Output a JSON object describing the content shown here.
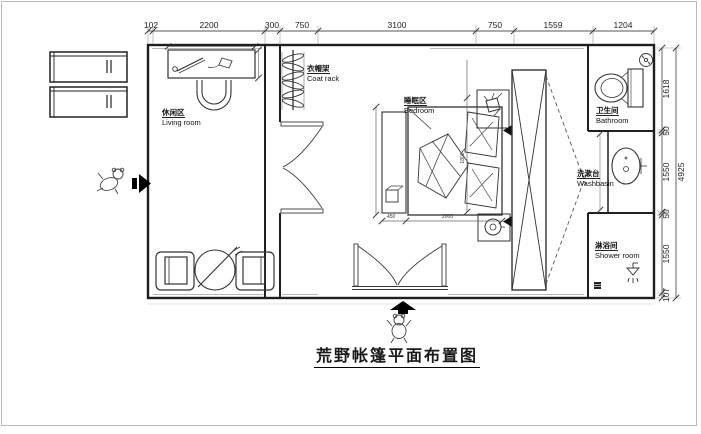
{
  "drawing": {
    "title": "荒野帐篷平面布置图"
  },
  "rooms": {
    "living": {
      "zh": "休闲区",
      "en": "Living room"
    },
    "coat_rack": {
      "zh": "衣帽架",
      "en": "Coat rack"
    },
    "bedroom": {
      "zh": "睡眠区",
      "en": "Bedroom"
    },
    "bathroom": {
      "zh": "卫生间",
      "en": "Bathroom"
    },
    "washbasin": {
      "zh": "洗漱台",
      "en": "Washbasin"
    },
    "shower": {
      "zh": "淋浴间",
      "en": "Shower room"
    }
  },
  "dims": {
    "top": [
      "102",
      "2200",
      "300",
      "750",
      "3100",
      "750",
      "1559",
      "1204"
    ],
    "right": [
      "1618",
      "50",
      "1550",
      "50",
      "1550",
      "107"
    ],
    "right_total": "4925",
    "furniture": {
      "nightstand_width": "450",
      "bed_length": "2000",
      "bed_width": "1800"
    }
  },
  "icons": {
    "entry_left": "arrow-right-icon",
    "entry_bottom": "arrow-up-icon",
    "mascot": "teddy-bear-icon"
  },
  "colors": {
    "line": "#1f1f1f",
    "dim": "#444444",
    "shadow": "#b0b0b0"
  }
}
